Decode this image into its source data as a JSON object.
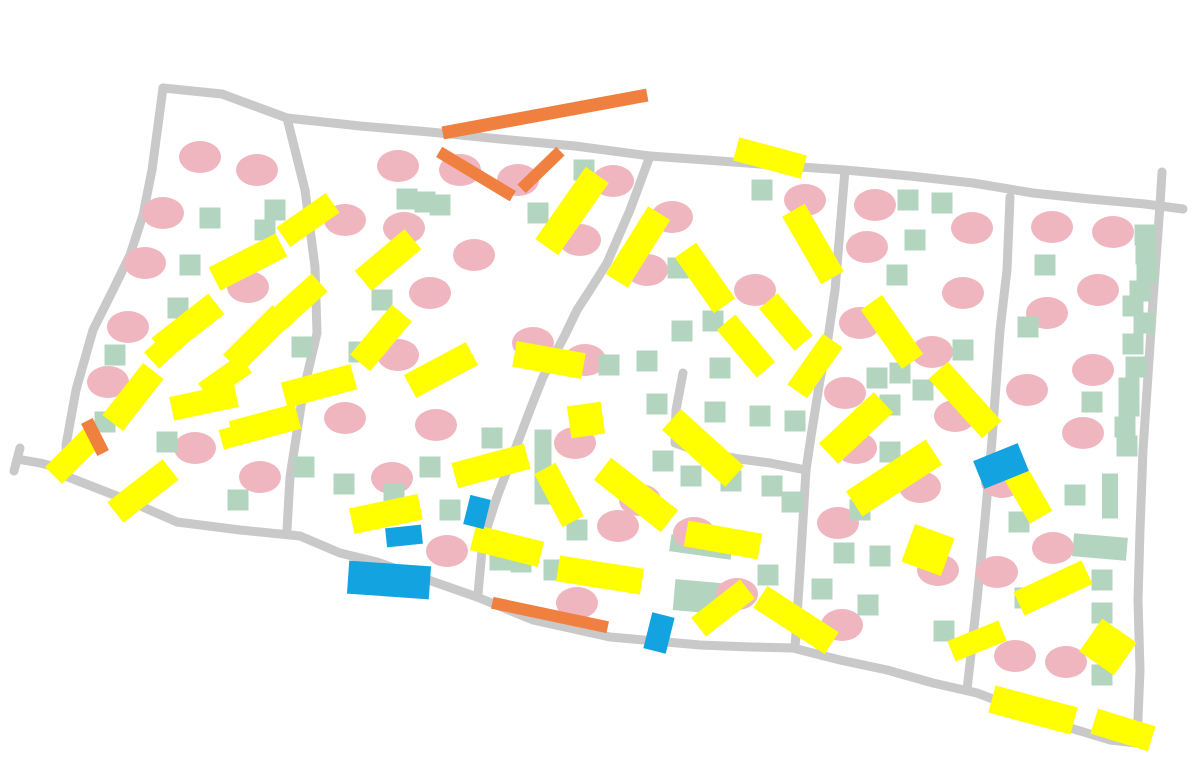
{
  "canvas": {
    "width": 1194,
    "height": 758,
    "background": "#ffffff"
  },
  "palette": {
    "road": "#c9c9c9",
    "pink": "#f0b6c0",
    "green": "#b3d5c0",
    "yellow": "#ffff00",
    "orange": "#f08040",
    "blue": "#14a3e1"
  },
  "roads": {
    "stroke_width": 9,
    "polylines": [
      [
        [
          163,
          88
        ],
        [
          222,
          94
        ],
        [
          287,
          118
        ],
        [
          360,
          126
        ],
        [
          430,
          132
        ],
        [
          500,
          139
        ],
        [
          575,
          146
        ],
        [
          650,
          156
        ],
        [
          720,
          161
        ],
        [
          800,
          167
        ],
        [
          845,
          170
        ],
        [
          910,
          176
        ],
        [
          973,
          183
        ],
        [
          1033,
          193
        ],
        [
          1090,
          199
        ],
        [
          1145,
          204
        ],
        [
          1183,
          209
        ]
      ],
      [
        [
          163,
          88
        ],
        [
          152,
          170
        ],
        [
          143,
          215
        ],
        [
          130,
          255
        ],
        [
          113,
          290
        ],
        [
          93,
          330
        ],
        [
          76,
          390
        ],
        [
          66,
          445
        ],
        [
          68,
          477
        ]
      ],
      [
        [
          68,
          470
        ],
        [
          40,
          463
        ],
        [
          17,
          459
        ]
      ],
      [
        [
          20,
          448
        ],
        [
          14,
          471
        ]
      ],
      [
        [
          68,
          477
        ],
        [
          127,
          500
        ],
        [
          177,
          522
        ],
        [
          240,
          530
        ],
        [
          300,
          536
        ],
        [
          340,
          553
        ],
        [
          377,
          562
        ],
        [
          437,
          583
        ],
        [
          477,
          597
        ],
        [
          533,
          620
        ],
        [
          610,
          637
        ],
        [
          700,
          645
        ],
        [
          750,
          647
        ],
        [
          793,
          648
        ],
        [
          840,
          660
        ],
        [
          887,
          670
        ],
        [
          933,
          683
        ],
        [
          977,
          693
        ],
        [
          1030,
          713
        ],
        [
          1067,
          727
        ],
        [
          1110,
          740
        ],
        [
          1137,
          743
        ]
      ],
      [
        [
          287,
          118
        ],
        [
          305,
          190
        ],
        [
          315,
          267
        ],
        [
          317,
          333
        ],
        [
          303,
          393
        ],
        [
          290,
          477
        ],
        [
          287,
          530
        ]
      ],
      [
        [
          650,
          156
        ],
        [
          630,
          210
        ],
        [
          607,
          263
        ],
        [
          590,
          290
        ],
        [
          577,
          310
        ],
        [
          565,
          335
        ],
        [
          543,
          377
        ],
        [
          530,
          410
        ],
        [
          510,
          463
        ],
        [
          497,
          497
        ],
        [
          483,
          540
        ],
        [
          478,
          594
        ]
      ],
      [
        [
          845,
          170
        ],
        [
          840,
          230
        ],
        [
          835,
          290
        ],
        [
          827,
          345
        ],
        [
          820,
          380
        ],
        [
          812,
          430
        ],
        [
          806,
          470
        ],
        [
          803,
          520
        ],
        [
          800,
          570
        ],
        [
          795,
          648
        ]
      ],
      [
        [
          683,
          373
        ],
        [
          676,
          410
        ],
        [
          675,
          443
        ],
        [
          700,
          452
        ],
        [
          740,
          459
        ],
        [
          770,
          463
        ],
        [
          806,
          470
        ]
      ],
      [
        [
          1010,
          197
        ],
        [
          1007,
          270
        ],
        [
          1000,
          330
        ],
        [
          992,
          440
        ],
        [
          985,
          520
        ],
        [
          977,
          600
        ],
        [
          967,
          690
        ]
      ],
      [
        [
          1162,
          172
        ],
        [
          1160,
          205
        ],
        [
          1153,
          300
        ],
        [
          1147,
          390
        ],
        [
          1143,
          450
        ],
        [
          1140,
          530
        ],
        [
          1138,
          600
        ],
        [
          1140,
          670
        ],
        [
          1137,
          743
        ]
      ]
    ]
  },
  "pink_dots": {
    "rx": 21,
    "ry": 16,
    "points": [
      [
        200,
        157
      ],
      [
        257,
        170
      ],
      [
        163,
        213
      ],
      [
        145,
        263
      ],
      [
        128,
        327
      ],
      [
        108,
        382
      ],
      [
        248,
        287
      ],
      [
        345,
        220
      ],
      [
        398,
        166
      ],
      [
        404,
        228
      ],
      [
        474,
        255
      ],
      [
        430,
        293
      ],
      [
        398,
        355
      ],
      [
        533,
        343
      ],
      [
        436,
        425
      ],
      [
        345,
        418
      ],
      [
        392,
        478
      ],
      [
        195,
        448
      ],
      [
        260,
        477
      ],
      [
        447,
        551
      ],
      [
        460,
        170
      ],
      [
        518,
        180
      ],
      [
        613,
        181
      ],
      [
        672,
        217
      ],
      [
        580,
        240
      ],
      [
        647,
        270
      ],
      [
        755,
        290
      ],
      [
        805,
        200
      ],
      [
        875,
        205
      ],
      [
        867,
        247
      ],
      [
        585,
        360
      ],
      [
        575,
        443
      ],
      [
        640,
        500
      ],
      [
        694,
        533
      ],
      [
        618,
        526
      ],
      [
        577,
        603
      ],
      [
        838,
        523
      ],
      [
        845,
        393
      ],
      [
        856,
        448
      ],
      [
        920,
        487
      ],
      [
        955,
        416
      ],
      [
        963,
        293
      ],
      [
        932,
        352
      ],
      [
        972,
        228
      ],
      [
        860,
        323
      ],
      [
        1002,
        482
      ],
      [
        997,
        572
      ],
      [
        842,
        625
      ],
      [
        1015,
        656
      ],
      [
        1066,
        662
      ],
      [
        1052,
        227
      ],
      [
        1113,
        232
      ],
      [
        1098,
        290
      ],
      [
        1047,
        313
      ],
      [
        1093,
        370
      ],
      [
        1027,
        390
      ],
      [
        1083,
        433
      ],
      [
        1053,
        548
      ],
      [
        737,
        594
      ],
      [
        938,
        570
      ]
    ]
  },
  "green_squares": {
    "size": 21,
    "points": [
      [
        210,
        218
      ],
      [
        265,
        230
      ],
      [
        275,
        210
      ],
      [
        190,
        265
      ],
      [
        178,
        308
      ],
      [
        115,
        355
      ],
      [
        105,
        422
      ],
      [
        167,
        442
      ],
      [
        238,
        500
      ],
      [
        407,
        199
      ],
      [
        425,
        202
      ],
      [
        440,
        205
      ],
      [
        538,
        213
      ],
      [
        584,
        170
      ],
      [
        382,
        300
      ],
      [
        302,
        347
      ],
      [
        359,
        352
      ],
      [
        304,
        467
      ],
      [
        344,
        484
      ],
      [
        394,
        494
      ],
      [
        450,
        510
      ],
      [
        430,
        467
      ],
      [
        492,
        438
      ],
      [
        577,
        530
      ],
      [
        500,
        560
      ],
      [
        521,
        562
      ],
      [
        554,
        570
      ],
      [
        762,
        190
      ],
      [
        678,
        268
      ],
      [
        713,
        321
      ],
      [
        682,
        331
      ],
      [
        647,
        361
      ],
      [
        720,
        368
      ],
      [
        609,
        365
      ],
      [
        657,
        404
      ],
      [
        715,
        412
      ],
      [
        760,
        416
      ],
      [
        795,
        421
      ],
      [
        663,
        461
      ],
      [
        691,
        476
      ],
      [
        731,
        481
      ],
      [
        772,
        486
      ],
      [
        792,
        502
      ],
      [
        768,
        575
      ],
      [
        908,
        200
      ],
      [
        942,
        203
      ],
      [
        915,
        240
      ],
      [
        897,
        275
      ],
      [
        963,
        350
      ],
      [
        900,
        373
      ],
      [
        923,
        390
      ],
      [
        877,
        378
      ],
      [
        890,
        405
      ],
      [
        890,
        452
      ],
      [
        860,
        510
      ],
      [
        880,
        556
      ],
      [
        868,
        605
      ],
      [
        944,
        631
      ],
      [
        1045,
        265
      ],
      [
        1028,
        327
      ],
      [
        1092,
        402
      ],
      [
        1075,
        495
      ],
      [
        1019,
        522
      ],
      [
        844,
        553
      ],
      [
        822,
        589
      ],
      [
        1025,
        598
      ],
      [
        1102,
        613
      ],
      [
        1102,
        580
      ],
      [
        1102,
        675
      ],
      [
        1145,
        235
      ],
      [
        1146,
        254
      ],
      [
        1147,
        273
      ],
      [
        1140,
        291
      ],
      [
        1133,
        306
      ],
      [
        1144,
        323
      ],
      [
        1133,
        344
      ],
      [
        1136,
        367
      ],
      [
        1129,
        388
      ],
      [
        1129,
        406
      ],
      [
        1125,
        427
      ],
      [
        1127,
        446
      ]
    ]
  },
  "green_rects": [
    [
      543,
      467,
      0,
      17,
      75
    ],
    [
      701,
      547,
      8,
      62,
      17
    ],
    [
      702,
      597,
      5,
      56,
      31
    ],
    [
      1110,
      496,
      0,
      16,
      45
    ],
    [
      1100,
      547,
      5,
      54,
      23
    ]
  ],
  "yellow_bars": [
    [
      308,
      220,
      -35,
      60,
      24
    ],
    [
      388,
      260,
      -40,
      65,
      26
    ],
    [
      248,
      262,
      -27,
      75,
      26
    ],
    [
      188,
      326,
      -38,
      72,
      26
    ],
    [
      172,
      342,
      -42,
      55,
      22
    ],
    [
      133,
      397,
      -52,
      66,
      26
    ],
    [
      204,
      402,
      -12,
      66,
      24
    ],
    [
      73,
      456,
      -45,
      55,
      24
    ],
    [
      143,
      491,
      -38,
      70,
      26
    ],
    [
      257,
      339,
      -45,
      70,
      26
    ],
    [
      243,
      434,
      -15,
      45,
      20
    ],
    [
      319,
      386,
      -15,
      72,
      26
    ],
    [
      265,
      425,
      -15,
      68,
      26
    ],
    [
      381,
      338,
      -50,
      65,
      26
    ],
    [
      441,
      370,
      -28,
      70,
      26
    ],
    [
      491,
      466,
      -15,
      75,
      26
    ],
    [
      549,
      360,
      10,
      70,
      26
    ],
    [
      586,
      420,
      -8,
      34,
      32
    ],
    [
      559,
      495,
      62,
      60,
      24
    ],
    [
      386,
      514,
      -12,
      70,
      26
    ],
    [
      507,
      546,
      14,
      70,
      26
    ],
    [
      600,
      575,
      9,
      85,
      26
    ],
    [
      636,
      495,
      38,
      85,
      28
    ],
    [
      723,
      540,
      10,
      75,
      26
    ],
    [
      572,
      211,
      -55,
      88,
      28
    ],
    [
      770,
      158,
      15,
      70,
      24
    ],
    [
      638,
      247,
      -58,
      80,
      26
    ],
    [
      705,
      278,
      55,
      68,
      26
    ],
    [
      813,
      244,
      60,
      78,
      26
    ],
    [
      746,
      346,
      50,
      62,
      24
    ],
    [
      786,
      322,
      50,
      55,
      24
    ],
    [
      703,
      448,
      42,
      85,
      28
    ],
    [
      815,
      366,
      -55,
      62,
      24
    ],
    [
      892,
      332,
      55,
      72,
      26
    ],
    [
      856,
      428,
      -43,
      75,
      28
    ],
    [
      894,
      478,
      -33,
      95,
      30
    ],
    [
      965,
      400,
      48,
      80,
      26
    ],
    [
      928,
      550,
      20,
      42,
      40
    ],
    [
      796,
      620,
      33,
      85,
      26
    ],
    [
      723,
      608,
      -38,
      62,
      24
    ],
    [
      977,
      641,
      -22,
      55,
      22
    ],
    [
      1053,
      588,
      -25,
      75,
      26
    ],
    [
      1033,
      710,
      15,
      85,
      28
    ],
    [
      1123,
      730,
      17,
      60,
      26
    ],
    [
      1108,
      647,
      35,
      42,
      40
    ],
    [
      1023,
      486,
      60,
      72,
      26
    ],
    [
      225,
      378,
      -35,
      50,
      22
    ],
    [
      298,
      302,
      -42,
      58,
      24
    ]
  ],
  "orange_bars": [
    [
      545,
      114,
      -10.5,
      208,
      13
    ],
    [
      476,
      174,
      31,
      86,
      12
    ],
    [
      541,
      170,
      -44,
      54,
      12
    ],
    [
      95,
      437,
      63,
      36,
      13
    ],
    [
      550,
      615,
      12,
      118,
      12
    ]
  ],
  "blue_shapes": [
    [
      389,
      580,
      4,
      82,
      33
    ],
    [
      404,
      536,
      -6,
      36,
      19
    ],
    [
      477,
      512,
      14,
      21,
      30
    ],
    [
      659,
      633,
      14,
      23,
      37
    ],
    [
      1001,
      466,
      -22,
      48,
      30
    ]
  ]
}
